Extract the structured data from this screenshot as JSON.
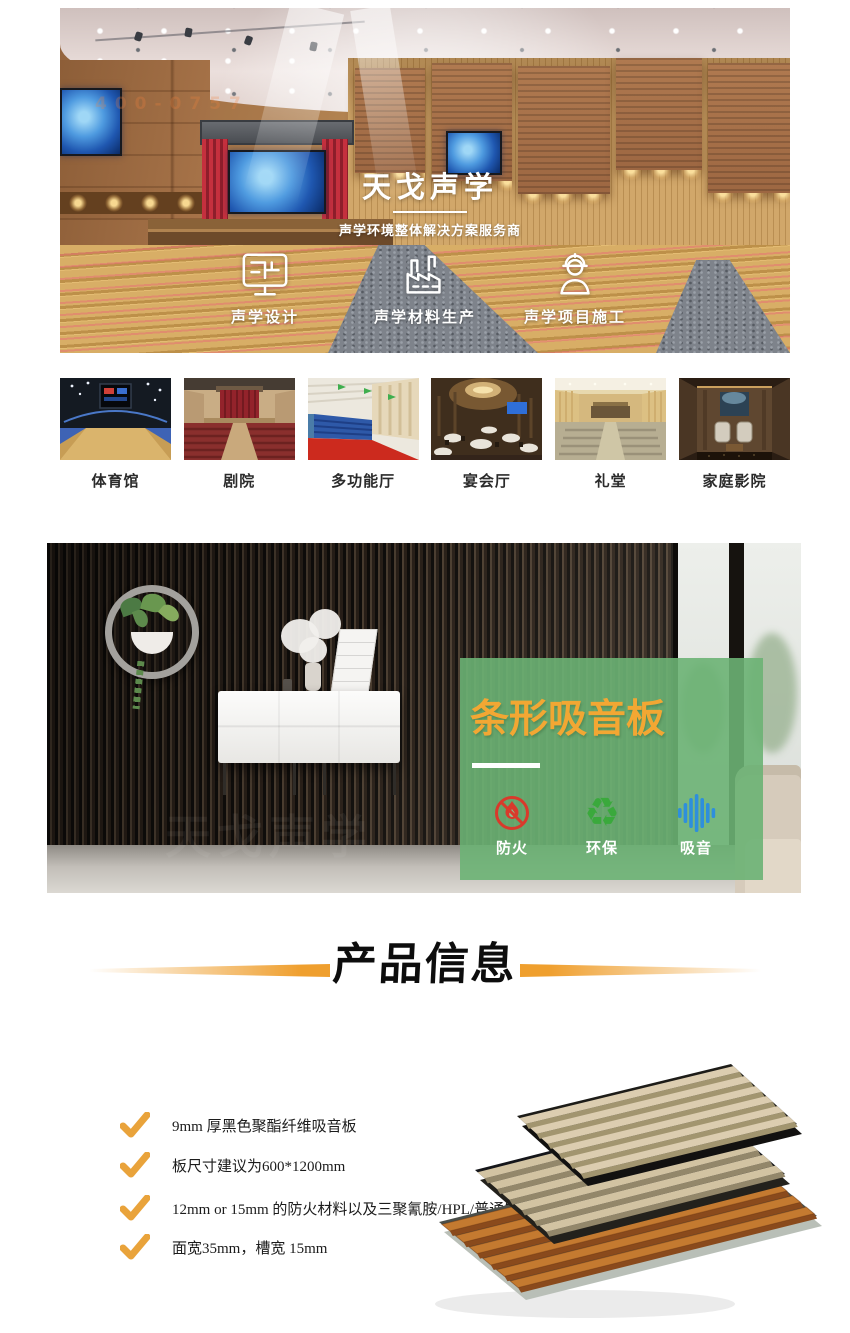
{
  "hero": {
    "title": "天戈声学",
    "subtitle": "声学环境整体解决方案服务商",
    "watermark": "400-0757",
    "features": [
      {
        "icon": "monitor-plan-icon",
        "label": "声学设计"
      },
      {
        "icon": "factory-icon",
        "label": "声学材料生产"
      },
      {
        "icon": "construction-worker-icon",
        "label": "声学项目施工"
      }
    ]
  },
  "venues": {
    "items": [
      {
        "icon": "gymnasium-thumb",
        "label": "体育馆"
      },
      {
        "icon": "theater-thumb",
        "label": "剧院"
      },
      {
        "icon": "multifunction-hall-thumb",
        "label": "多功能厅"
      },
      {
        "icon": "banquet-hall-thumb",
        "label": "宴会厅"
      },
      {
        "icon": "auditorium-thumb",
        "label": "礼堂"
      },
      {
        "icon": "home-cinema-thumb",
        "label": "家庭影院"
      }
    ]
  },
  "showcase": {
    "panel_title": "条形吸音板",
    "watermark": "天戈声学",
    "colors": {
      "panel_green": "#6cb274",
      "title_orange": "#f2a733",
      "fire_red": "#d93a2b",
      "recycle_green": "#3aa93c",
      "sound_blue": "#2e8fdc"
    },
    "features": [
      {
        "icon": "fireproof-icon",
        "label": "防火"
      },
      {
        "icon": "recycle-icon",
        "label": "环保",
        "glyph": "♻"
      },
      {
        "icon": "sound-absorb-icon",
        "label": "吸音"
      }
    ]
  },
  "product_info": {
    "heading": "产品信息",
    "accent_color": "#ef9f2e",
    "bullets": [
      {
        "text": "9mm 厚黑色聚酯纤维吸音板"
      },
      {
        "text": "板尺寸建议为600*1200mm"
      },
      {
        "text": "12mm or 15mm 的防火材料以及三聚氰胺/HPL/普通饰面"
      },
      {
        "text": "面宽35mm，槽宽 15mm"
      }
    ]
  }
}
